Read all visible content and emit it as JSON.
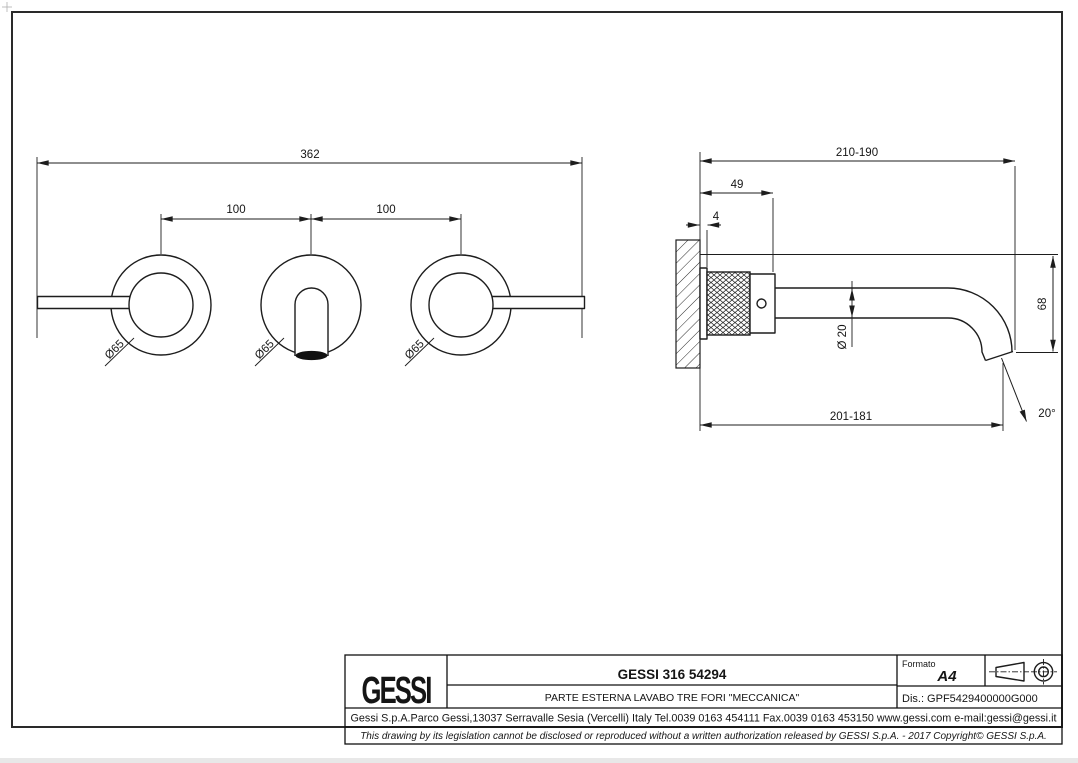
{
  "drawing": {
    "front_view": {
      "dim_total_width": "362",
      "dim_hole_spacing_left": "100",
      "dim_hole_spacing_right": "100",
      "dim_rosette_left": "Ø65",
      "dim_rosette_center": "Ø65",
      "dim_rosette_right": "Ø65"
    },
    "side_view": {
      "dim_depth_range": "210-190",
      "dim_body_depth": "49",
      "dim_flange_thickness": "4",
      "dim_spout_diameter": "Ø 20",
      "dim_drop_height": "68",
      "dim_reach_range": "201-181",
      "dim_outlet_angle": "20°"
    },
    "title_block": {
      "logo": "GESSI",
      "product_code": "GESSI 316 54294",
      "description": "PARTE ESTERNA LAVABO TRE FORI \"MECCANICA\"",
      "format_label": "Formato",
      "format_value": "A4",
      "drawing_number": "Dis.: GPF5429400000G000",
      "company_line": "Gessi S.p.A.Parco Gessi,13037 Serravalle Sesia (Vercelli) Italy Tel.0039 0163 454111 Fax.0039 0163 453150 www.gessi.com e-mail:gessi@gessi.it",
      "legal_line": "This drawing by its legislation cannot be disclosed or reproduced without a written authorization released by GESSI S.p.A. - 2017 Copyright© GESSI S.p.A."
    },
    "colors": {
      "line": "#1d1d1d",
      "background": "#ffffff"
    }
  }
}
